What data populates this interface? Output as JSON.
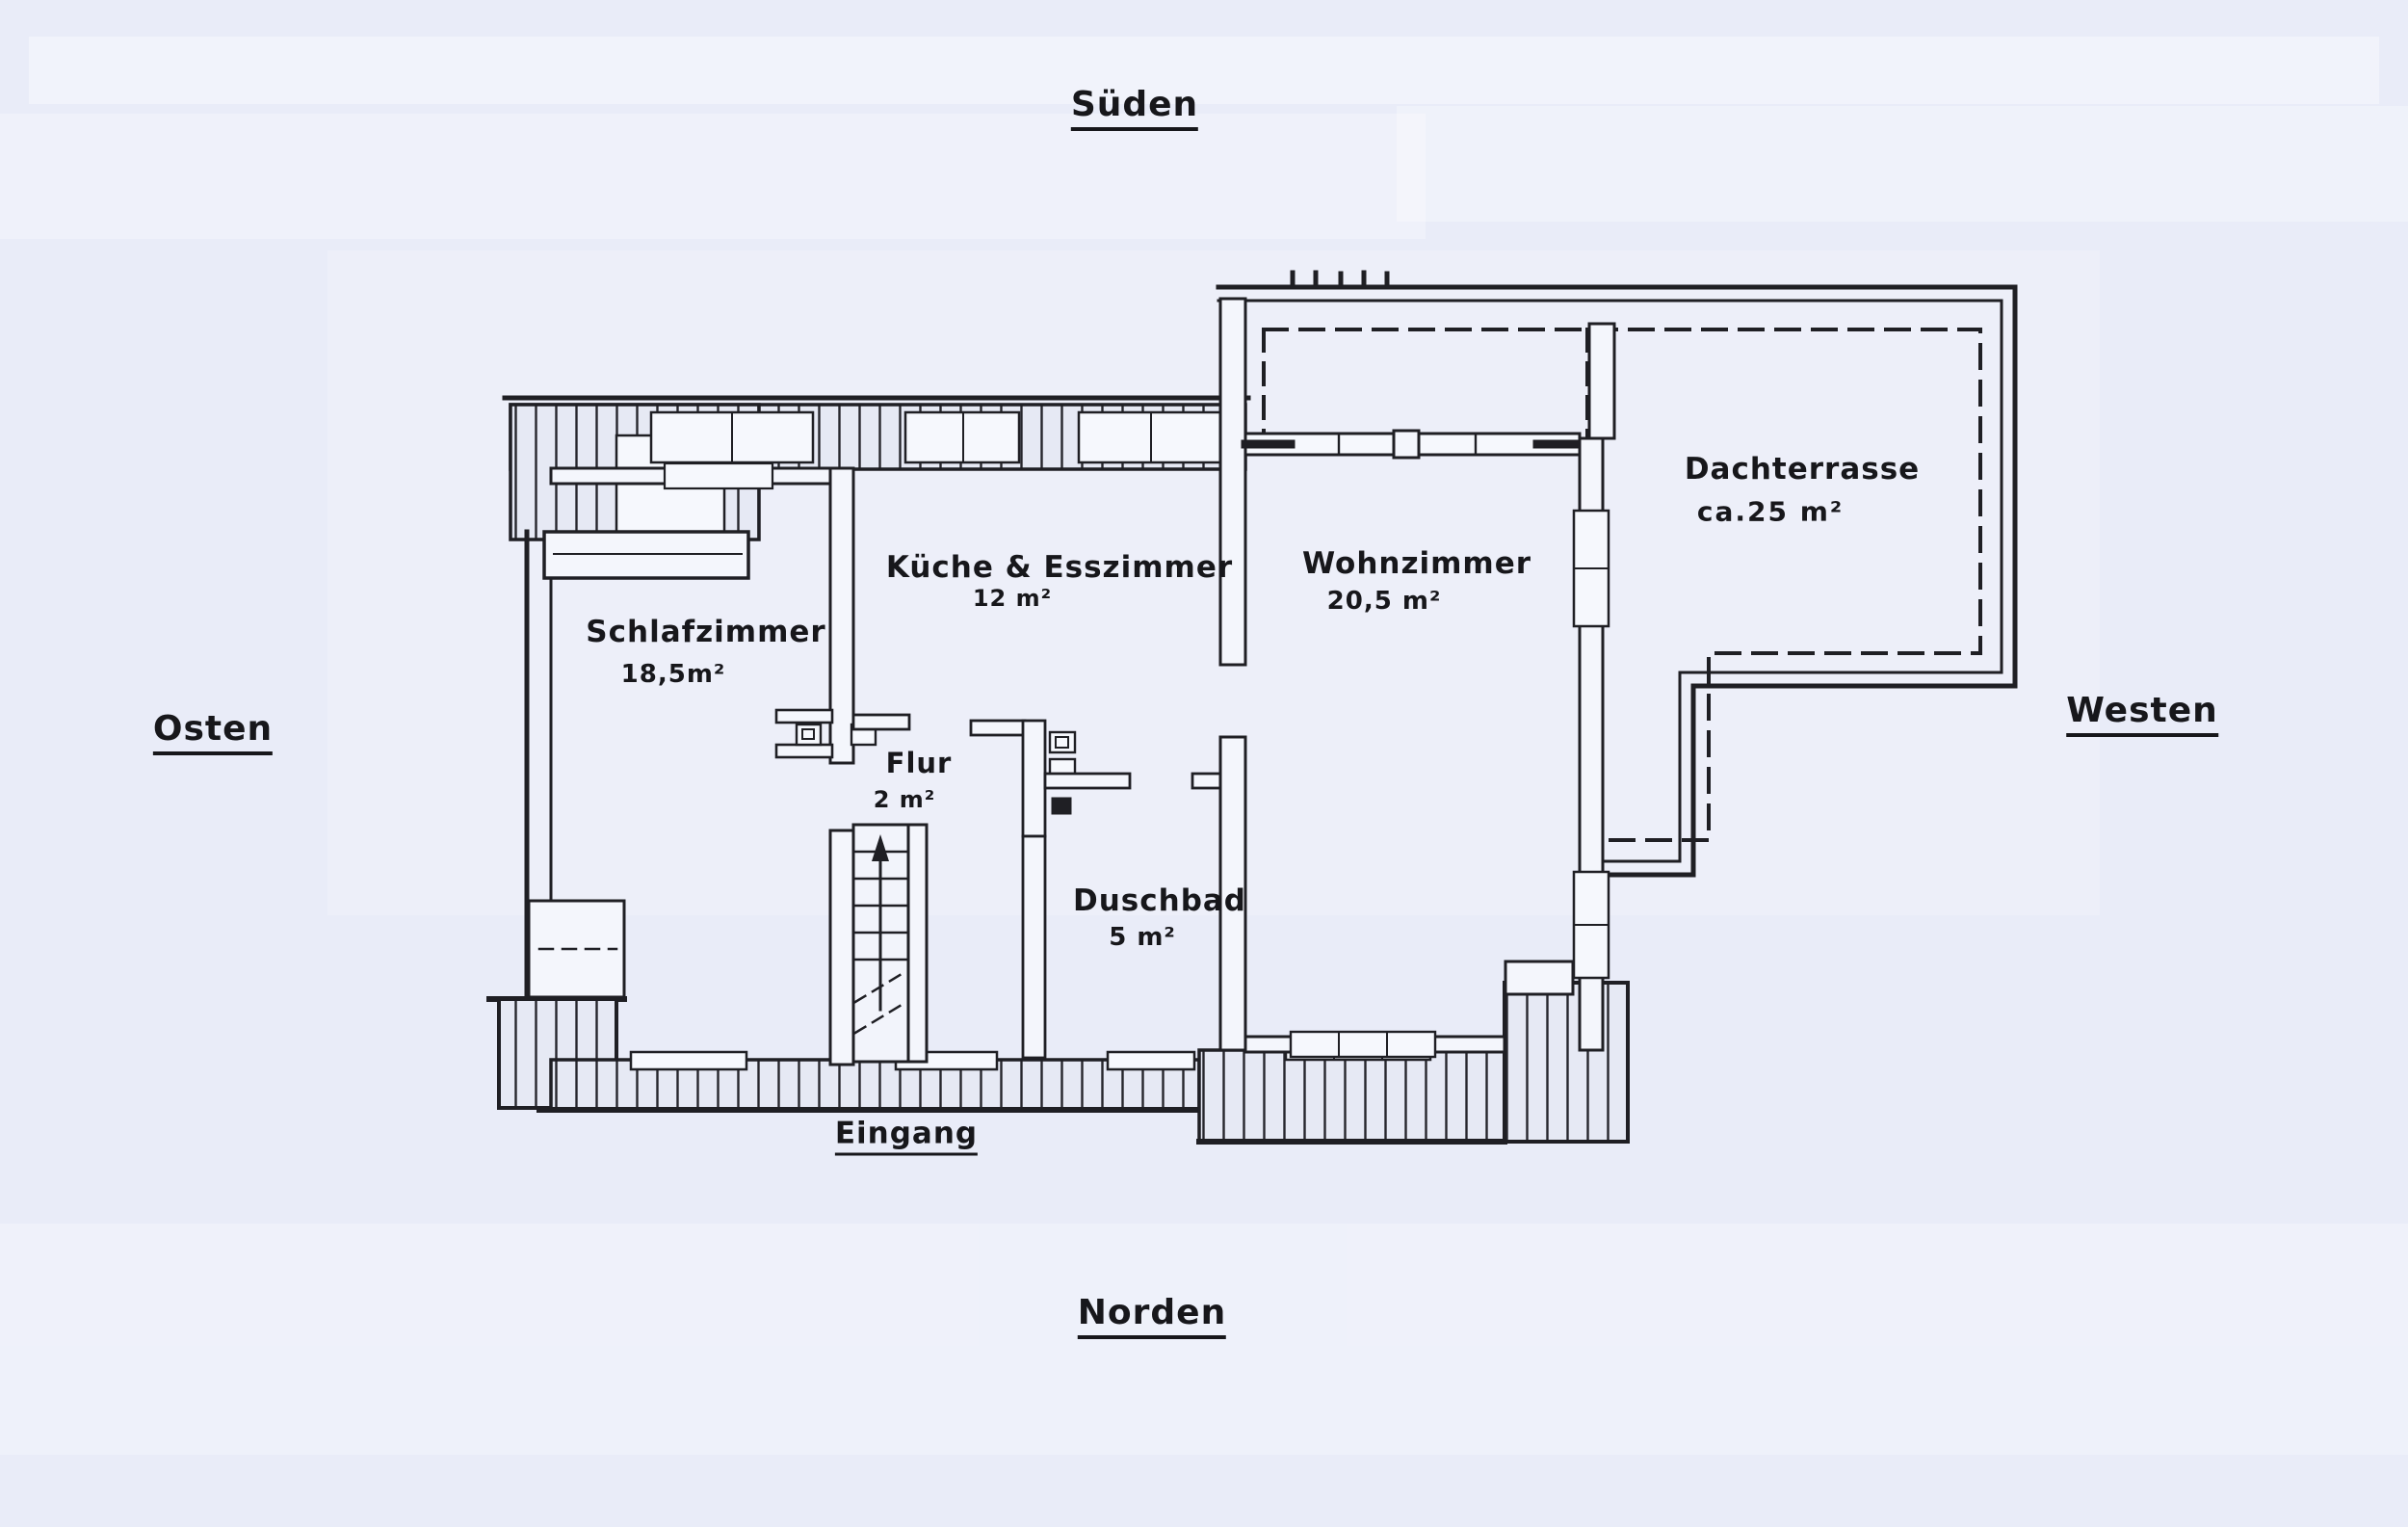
{
  "document": {
    "kind_hint": "hand-drawn apartment floor plan scan",
    "colors": {
      "ink": "#1f1f24",
      "paper": "#e9ecf8"
    }
  },
  "compass": {
    "south": "Süden",
    "east": "Osten",
    "west": "Westen",
    "north": "Norden"
  },
  "entrance": {
    "label": "Eingang"
  },
  "rooms": {
    "schlafzimmer": {
      "name": "Schlafzimmer",
      "area": "18,5m²"
    },
    "kueche": {
      "name": "Küche & Esszimmer",
      "area": "12 m²"
    },
    "wohnzimmer": {
      "name": "Wohnzimmer",
      "area": "20,5 m²"
    },
    "dachterrasse": {
      "name": "Dachterrasse",
      "area": "ca.25 m²"
    },
    "flur": {
      "name": "Flur",
      "area": "2 m²"
    },
    "duschbad": {
      "name": "Duschbad",
      "area": "5 m²"
    }
  }
}
